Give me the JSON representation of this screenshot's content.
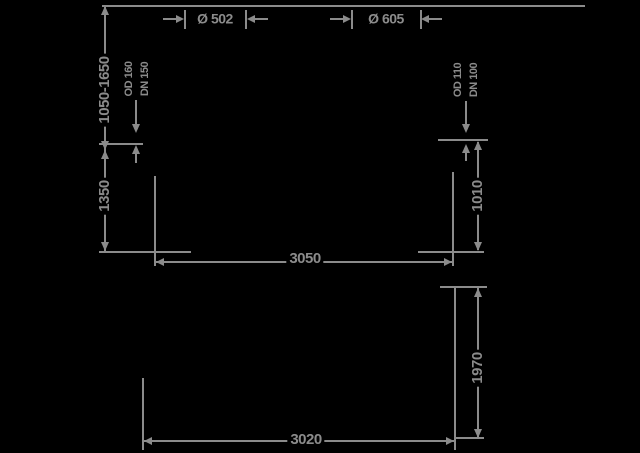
{
  "colors": {
    "background": "#000000",
    "line": "#8b8b8b"
  },
  "side_view": {
    "shaft_left_diameter": "Ø 502",
    "shaft_right_diameter": "Ø 605",
    "depth_adjustable": "1050-1650",
    "inlet_invert_depth": "1350",
    "inlet_pipe": {
      "od": "OD 160",
      "dn": "DN 150"
    },
    "outlet_pipe": {
      "od": "OD 110",
      "dn": "DN 100"
    },
    "outlet_invert_height": "1010",
    "overall_length": "3050"
  },
  "plan_view": {
    "width": "1970",
    "length": "3020"
  }
}
